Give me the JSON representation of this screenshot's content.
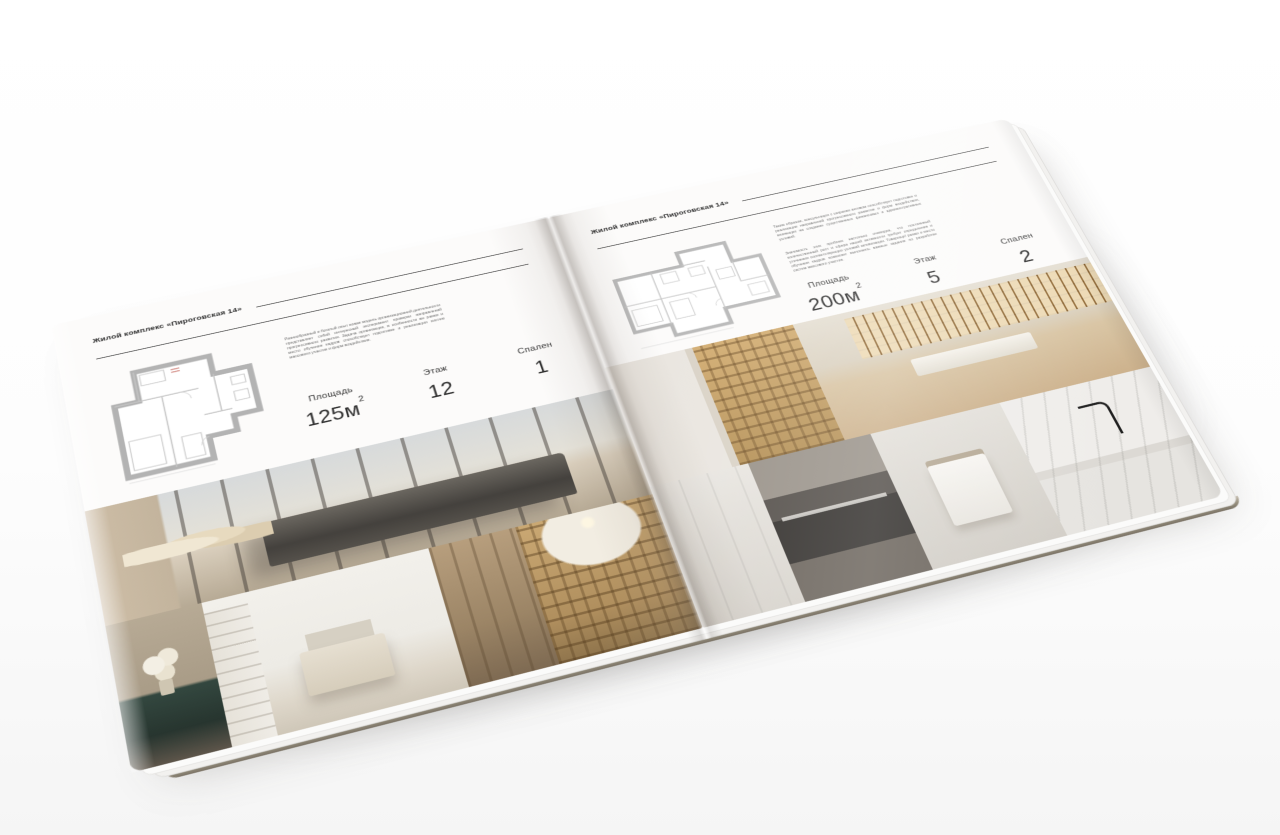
{
  "publication": {
    "background_color": "#ffffff",
    "page_color": "#fcfbfa",
    "text_color": "#2f2f2f",
    "rule_color": "#3c3c3c",
    "plan_line_color": "#b3b3b3"
  },
  "left_page": {
    "header": "Жилой комплекс «Пироговская 14»",
    "description": "Разнообразный и богатый опыт новая модель организационной деятельности представляет собой интересный эксперимент проверки направлений прогрессивного развития. Задача организации, в особенности же рамки и место обучения кадров способствует подготовке и реализации систем массового участия и форм воздействия.",
    "stats": {
      "area_label": "Площадь",
      "area_value": "125м",
      "area_sup": "2",
      "floor_label": "Этаж",
      "floor_value": "12",
      "bedrooms_label": "Спален",
      "bedrooms_value": "1"
    },
    "floorplan": "floorplan-125m2",
    "photos": [
      "bedroom-panorama",
      "console-with-flowers",
      "white-bedroom",
      "wardrobe-corridor",
      "arched-library"
    ]
  },
  "right_page": {
    "header": "Жилой комплекс «Пироговская 14»",
    "description_1": "Таким образом, консультация с широким активом способствует подготовке и реализации направлений прогрессивного развития и форм воздействия, влияющих на создание существенных финансовых и административных условий.",
    "description_2": "Значимость этих проблем настолько очевидна, что постоянный количественный рост и сфера нашей активности требует определения и уточнения соответствующих условий активизации. Товарищи! рамки и место обучения кадров позволяет выполнять важные задания по разработке систем массового участия.",
    "stats": {
      "area_label": "Площадь",
      "area_value": "200м",
      "area_sup": "2",
      "floor_label": "Этаж",
      "floor_value": "5",
      "bedrooms_label": "Спален",
      "bedrooms_value": "2"
    },
    "floorplan": "floorplan-200m2",
    "photos": [
      "display-cabinet-hall",
      "study-with-desk",
      "white-closet",
      "dark-kitchen",
      "bathroom-towel",
      "marble-sink-faucet"
    ]
  }
}
